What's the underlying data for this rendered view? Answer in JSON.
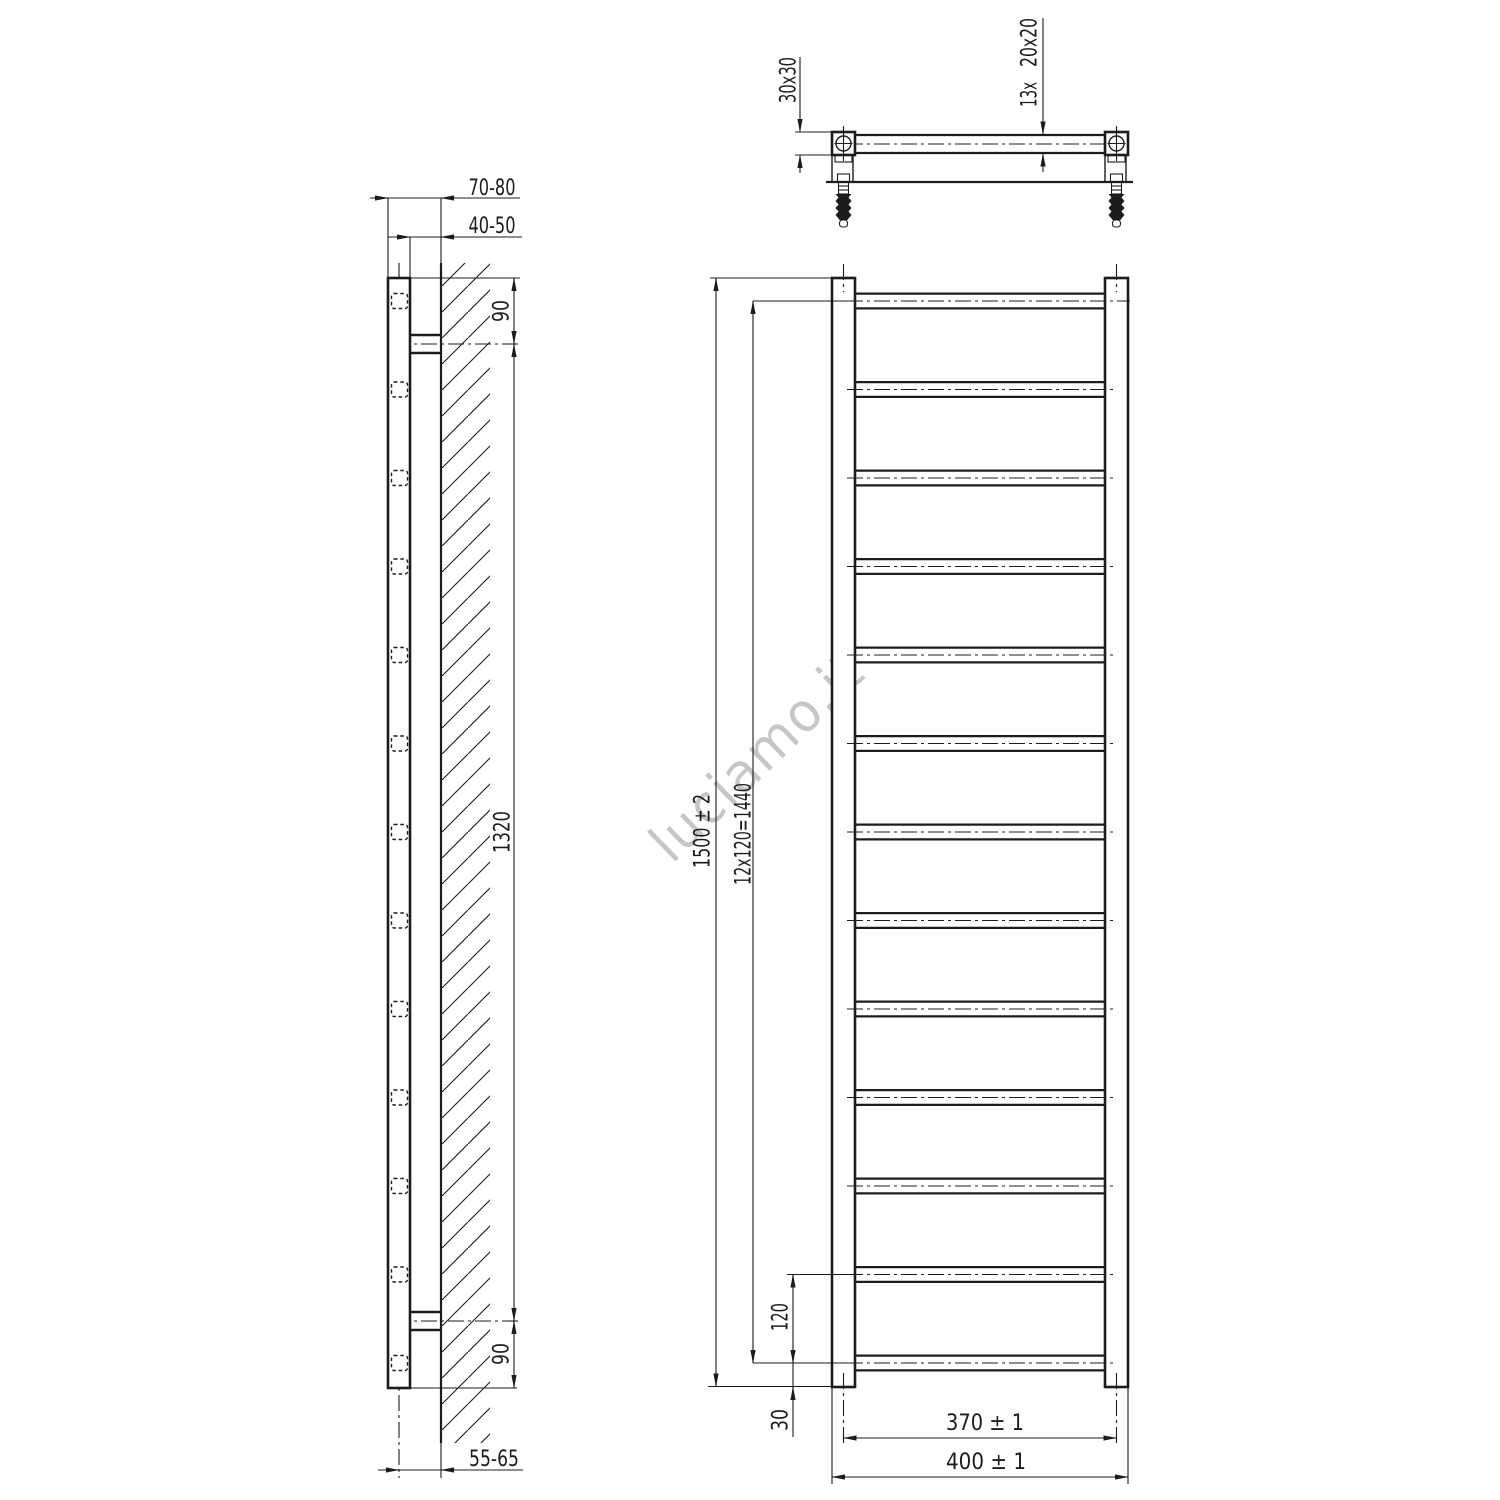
{
  "watermark": "luciamo.it",
  "line_color": "#1c1c1c",
  "watermark_color": "#c6c6c6",
  "side_view": {
    "dim_wall_to_front": "70-80",
    "dim_wall_to_back": "40-50",
    "dim_top_bracket": "90",
    "dim_bracket_span": "1320",
    "dim_bottom_bracket": "90",
    "dim_wall_to_rung_axis": "55-65"
  },
  "top_view": {
    "dim_tube_section": "30x30",
    "rung_count_label": "13x",
    "dim_rung_section": "20x20"
  },
  "front_view": {
    "rung_count": 13,
    "dim_total_height": "1500 ± 2",
    "dim_rung_pitch": "12x120=1440",
    "dim_last_pitch": "120",
    "dim_bottom_offset": "30",
    "dim_axis_width": "370 ± 1",
    "dim_total_width": "400 ± 1"
  }
}
